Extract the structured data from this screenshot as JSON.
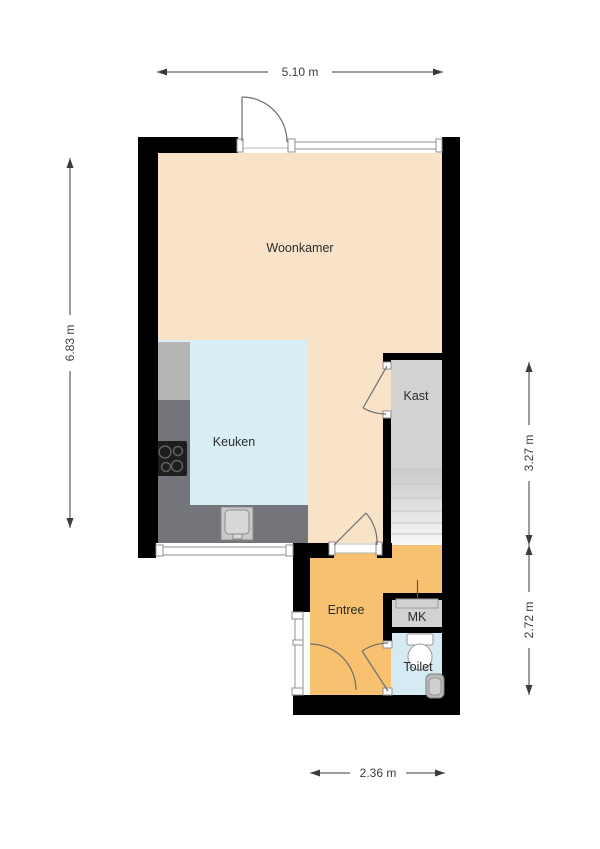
{
  "rooms": {
    "woonkamer": "Woonkamer",
    "keuken": "Keuken",
    "kast": "Kast",
    "entree": "Entree",
    "mk": "MK",
    "toilet": "Toilet"
  },
  "dimensions": {
    "width_top": "5.10 m",
    "height_left": "6.83 m",
    "height_right_upper": "3.27 m",
    "height_right_lower": "2.72 m",
    "width_bottom": "2.36 m"
  },
  "colors": {
    "wall": "#000000",
    "woonkamer_floor": "#f8e3c9",
    "keuken_floor": "#daeef6",
    "kast_floor": "#d2d2d2",
    "entree_floor": "#f8c170",
    "mk_floor": "#d2d2d2",
    "toilet_floor": "#d5eaf2",
    "counter_dark": "#74747b",
    "counter_light": "#b5b5b5",
    "stove": "#1e1e1e",
    "mk_door": "#d2d2d2"
  }
}
